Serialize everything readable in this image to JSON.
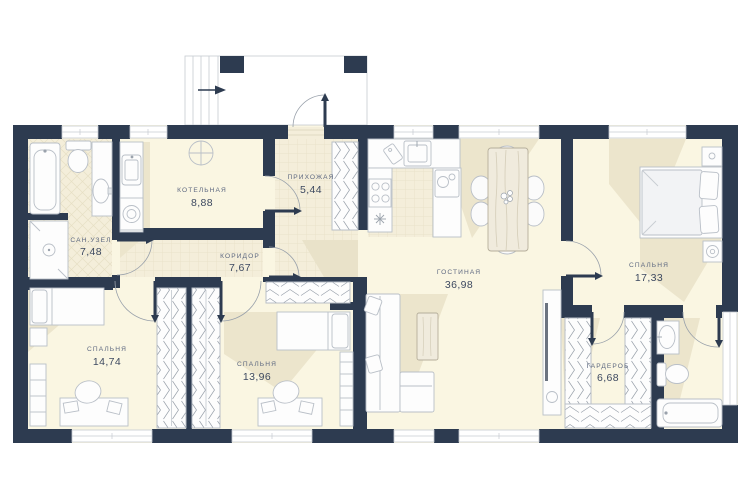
{
  "plan_title": "Floor plan",
  "colors": {
    "wall": "#2d3b50",
    "floor": "#faf6e2",
    "tile": "#f4eeda",
    "tile_line": "#e6dfc4",
    "shadow": "#ece5cc",
    "furniture_stroke": "#b9bfc7",
    "hatch": "#98a0aa",
    "label_text": "#5d6880",
    "area_text": "#3d4960"
  },
  "rooms": [
    {
      "id": "kotelnaya",
      "name": "КОТЕЛЬНАЯ",
      "area": "8,88"
    },
    {
      "id": "prihozhaya",
      "name": "ПРИХОЖАЯ",
      "area": "5,44"
    },
    {
      "id": "sanuzel",
      "name": "САН.УЗЕЛ",
      "area": "7,48"
    },
    {
      "id": "koridor",
      "name": "КОРИДОР",
      "area": "7,67"
    },
    {
      "id": "gostinaya",
      "name": "ГОСТИНАЯ",
      "area": "36,98"
    },
    {
      "id": "spalnya-master",
      "name": "СПАЛЬНЯ",
      "area": "17,33"
    },
    {
      "id": "spalnya-left",
      "name": "СПАЛЬНЯ",
      "area": "14,74"
    },
    {
      "id": "spalnya-mid",
      "name": "СПАЛЬНЯ",
      "area": "13,96"
    },
    {
      "id": "garderob",
      "name": "ГАРДЕРОБ",
      "area": "6,68"
    }
  ]
}
